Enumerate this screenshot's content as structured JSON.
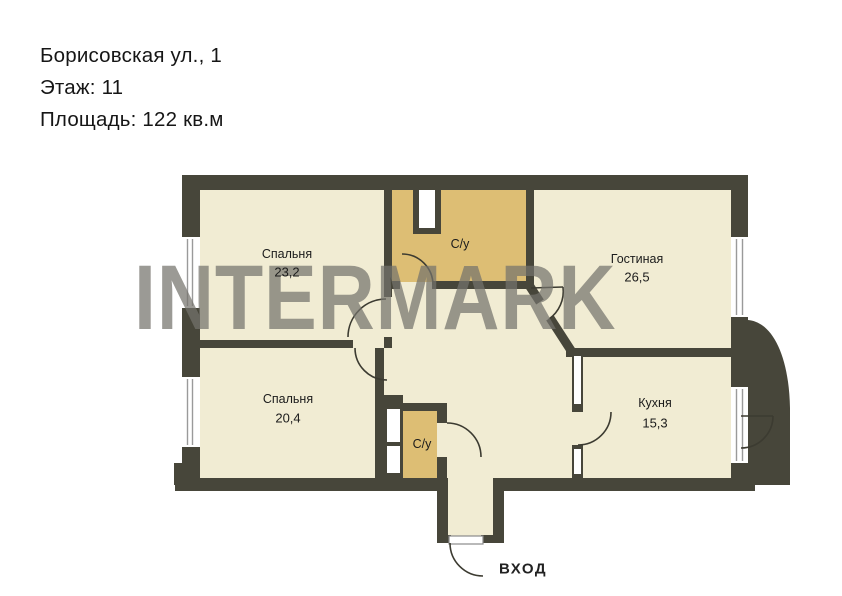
{
  "header": {
    "address": "Борисовская ул., 1",
    "floor": "Этаж: 11",
    "area": "Площадь: 122 кв.м"
  },
  "watermark": "INTERMARK",
  "plan": {
    "rooms": [
      {
        "id": "bedroom-top",
        "name": "Спальня",
        "area": "23,2"
      },
      {
        "id": "bathroom-top",
        "name": "С/у",
        "area": ""
      },
      {
        "id": "living-room",
        "name": "Гостиная",
        "area": "26,5"
      },
      {
        "id": "bedroom-bottom",
        "name": "Спальня",
        "area": "20,4"
      },
      {
        "id": "bathroom-bottom",
        "name": "С/у",
        "area": ""
      },
      {
        "id": "kitchen",
        "name": "Кухня",
        "area": "15,3"
      }
    ],
    "entrance_label": "ВХОД",
    "colors": {
      "wall": "#47463a",
      "room": "#f1ecd3",
      "wet": "#ddbe74",
      "balcony": "#e2c67e"
    }
  }
}
